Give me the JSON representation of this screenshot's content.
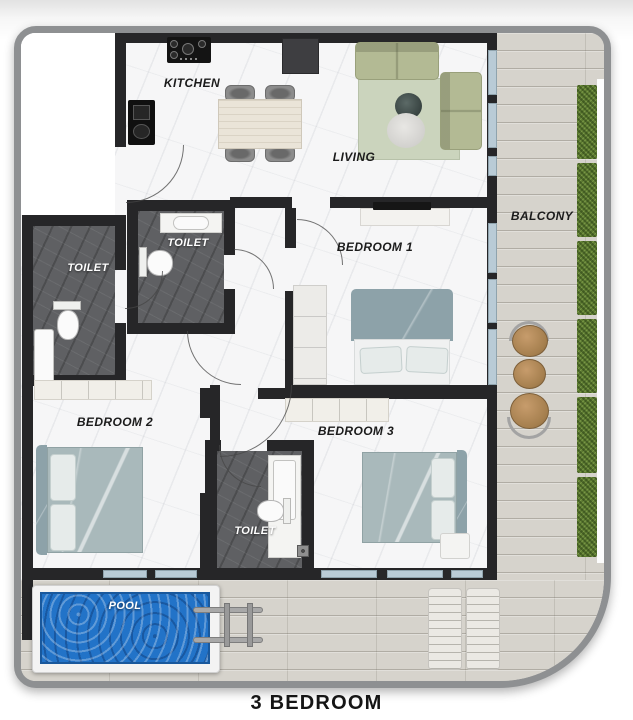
{
  "plan_title": "3 BEDROOM",
  "rooms": {
    "kitchen": {
      "label": "KITCHEN"
    },
    "living": {
      "label": "LIVING"
    },
    "balcony": {
      "label": "BALCONY"
    },
    "bedroom1": {
      "label": "BEDROOM 1"
    },
    "bedroom2": {
      "label": "BEDROOM 2"
    },
    "bedroom3": {
      "label": "BEDROOM 3"
    },
    "toilet_upper_left": {
      "label": "TOILET"
    },
    "toilet_upper_mid": {
      "label": "TOILET"
    },
    "toilet_lower": {
      "label": "TOILET"
    },
    "pool": {
      "label": "POOL"
    }
  },
  "colors": {
    "wall": "#262628",
    "toilet-floor": "#5f6063",
    "wood-floor": "#d6d3cc",
    "hedge": "#5c7a31",
    "pool-water": "#2273c8",
    "sofa": "#b3ba94",
    "rug": "#cbd4bd",
    "bed": "#a9b9bb",
    "headboard": "#8da2a9",
    "glass": "#b9cbd6",
    "label": "#1b1b1b"
  }
}
